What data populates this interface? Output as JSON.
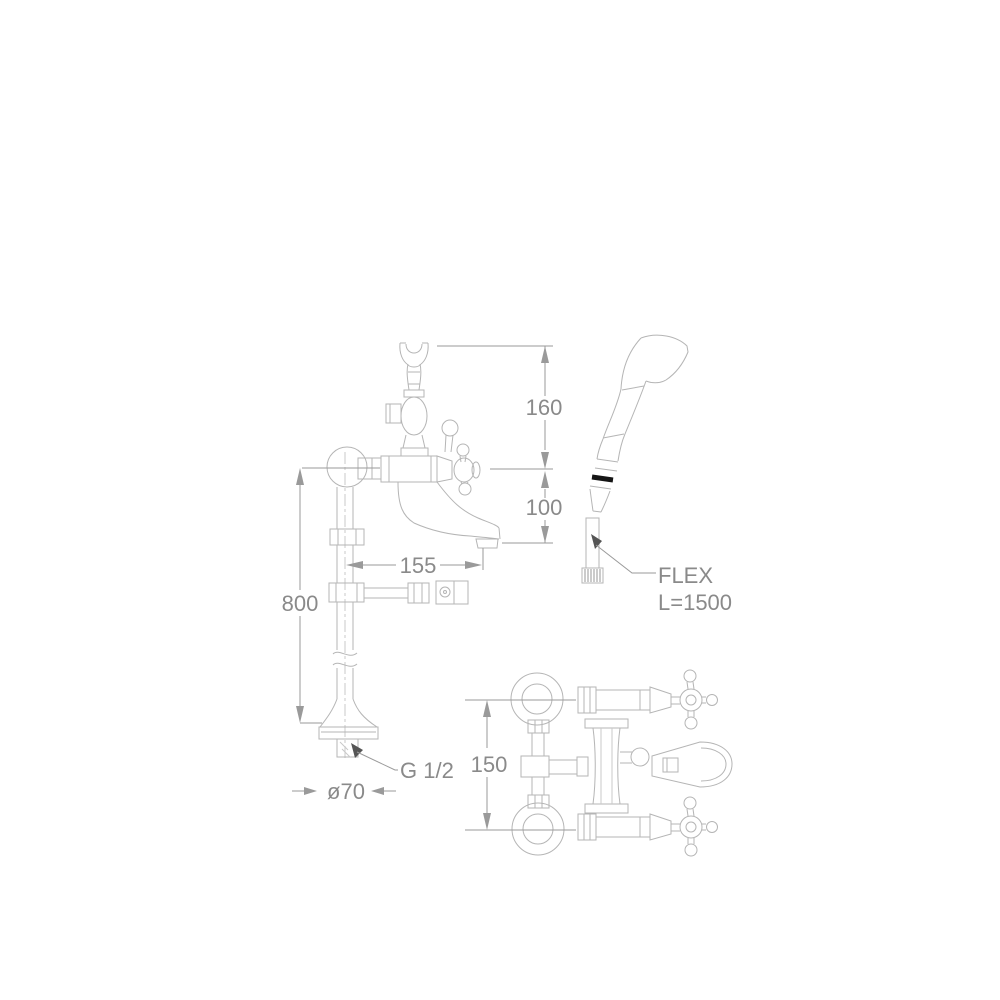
{
  "drawing": {
    "title": "bath-mixer-technical-drawing",
    "colors": {
      "line": "#b5b5b5",
      "line_soft": "#c9c9c9",
      "dimension": "#9a9a9a",
      "text": "#8a8a8a",
      "leader": "#555555",
      "band": "#151515",
      "background": "#ffffff"
    },
    "labels": {
      "dim_cradle_height": "160",
      "dim_spout_drop": "100",
      "dim_spout_reach": "155",
      "dim_riser_height": "800",
      "dim_inlet_distance": "150",
      "thread_size": "G 1/2",
      "base_diameter": "ø70",
      "flex_name": "FLEX",
      "flex_length": "L=1500"
    }
  }
}
